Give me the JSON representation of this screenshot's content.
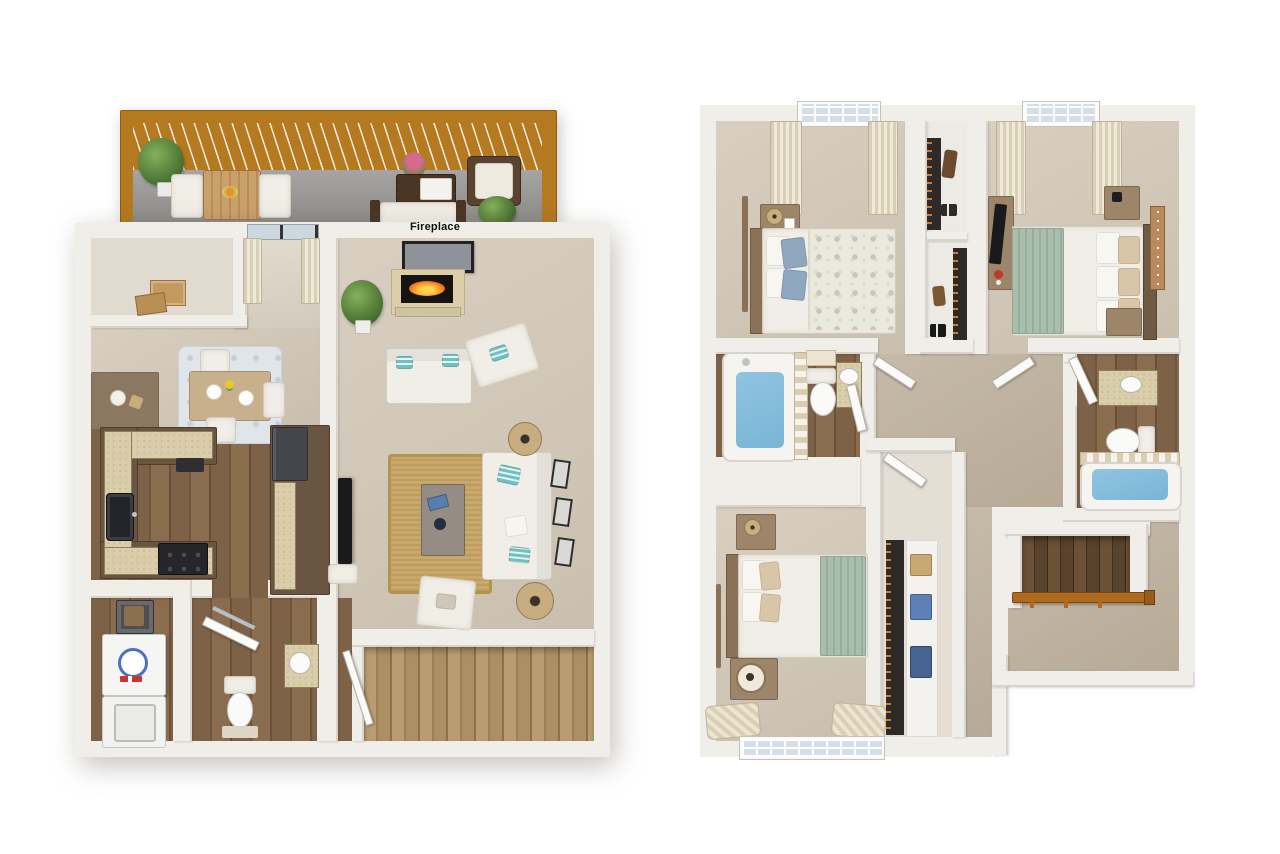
{
  "image": {
    "kind": "3d-floor-plan-rendering",
    "width": 1280,
    "height": 854,
    "panels": 2
  },
  "colors": {
    "wall": "#f0eee9",
    "wallFace": "#d8d4cc",
    "carpet": "#c9bfae",
    "carpetHi": "#d8cfc1",
    "hallCarpet": "#b6aa97",
    "wood": "#7e6247",
    "deckWood": "#b5791f",
    "concrete": "#969593",
    "counter": "#d8cca9",
    "cabinet": "#6a5542",
    "jute": "#c9a869",
    "blueRug": "#e0e5ea",
    "sofa": "#f1eee7",
    "teal": "#6fc0c2",
    "sage": "#a9bead",
    "water": "#7ab5d6",
    "curtain": "#d8cfb6",
    "glass": "#d5dfe7",
    "stairLight": "#b99c72",
    "stairDark": "#553f2a",
    "rail": "#b06a1f",
    "tv": "#1a1a1c",
    "taupe": "#9c8568",
    "fire": "#ff9226",
    "pillowBlue": "#8fa6bf",
    "denim": "#46648f",
    "shirtBlue": "#5d7fb5",
    "hangerOrange": "#c97a2e",
    "sign": "#b98a5c"
  },
  "plans": [
    {
      "name": "first-floor",
      "wall_label": "Fireplace",
      "rooms": [
        {
          "name": "deck",
          "furniture": [
            "potted-plant",
            "patio-dining-table",
            "patio-chairs",
            "fruit-bowl",
            "flower-vase",
            "wicker-coffee-table",
            "wicker-armchair",
            "patio-loveseat",
            "potted-plant-2"
          ]
        },
        {
          "name": "storage-closet",
          "furniture": [
            "cardboard-boxes"
          ]
        },
        {
          "name": "entry",
          "furniture": [
            "console-table",
            "decor-bowl",
            "sliding-glass-door",
            "curtains"
          ]
        },
        {
          "name": "dining-area",
          "furniture": [
            "dining-table",
            "dining-chairs",
            "area-rug",
            "place-settings",
            "flowers"
          ]
        },
        {
          "name": "kitchen",
          "furniture": [
            "u-shaped-cabinets",
            "double-sink",
            "range",
            "refrigerator",
            "island-counter",
            "countertop-appliance"
          ]
        },
        {
          "name": "living-room",
          "furniture": [
            "fireplace",
            "framed-art",
            "floor-plant",
            "loveseat",
            "accent-armchair",
            "sofa",
            "coffee-table",
            "jute-rug",
            "drum-lamps",
            "wall-frames",
            "tv",
            "tv-stand"
          ]
        },
        {
          "name": "laundry",
          "furniture": [
            "washer",
            "dryer",
            "waste-bin"
          ]
        },
        {
          "name": "half-bath",
          "furniture": [
            "toilet",
            "vanity-sink",
            "towel-bar",
            "bath-mat",
            "door"
          ]
        },
        {
          "name": "staircase",
          "furniture": [
            "wood-steps",
            "handrail"
          ]
        }
      ]
    },
    {
      "name": "second-floor",
      "rooms": [
        {
          "name": "bedroom-2",
          "furniture": [
            "bed",
            "blue-pillows",
            "floral-duvet",
            "nightstand",
            "table-lamp",
            "floor-mirror",
            "window",
            "curtains"
          ]
        },
        {
          "name": "hall-closet",
          "furniture": [
            "hanging-clothes",
            "boots",
            "shoes",
            "shelves"
          ]
        },
        {
          "name": "master-bedroom",
          "furniture": [
            "bed",
            "sage-throw",
            "accent-pillows",
            "nightstands",
            "dresser",
            "tv",
            "wall-sign",
            "window",
            "curtains",
            "flower-vase"
          ]
        },
        {
          "name": "bathroom-1",
          "furniture": [
            "tub",
            "shower-curtain",
            "shower-head",
            "toilet",
            "vanity-sink",
            "towel",
            "door"
          ]
        },
        {
          "name": "hallway",
          "furniture": [
            "doors"
          ]
        },
        {
          "name": "bathroom-2",
          "furniture": [
            "vanity-sink",
            "toilet",
            "tub",
            "shower-curtain",
            "door"
          ]
        },
        {
          "name": "bedroom-3",
          "furniture": [
            "bed",
            "sage-throw",
            "nightstands",
            "alarm-clock",
            "table-lamp",
            "window",
            "curtains"
          ]
        },
        {
          "name": "walk-in-closet",
          "furniture": [
            "hanging-clothes",
            "shelving",
            "storage-box",
            "folded-shirts",
            "jeans"
          ]
        },
        {
          "name": "staircase",
          "furniture": [
            "wood-steps",
            "handrail",
            "balusters"
          ]
        }
      ]
    }
  ]
}
